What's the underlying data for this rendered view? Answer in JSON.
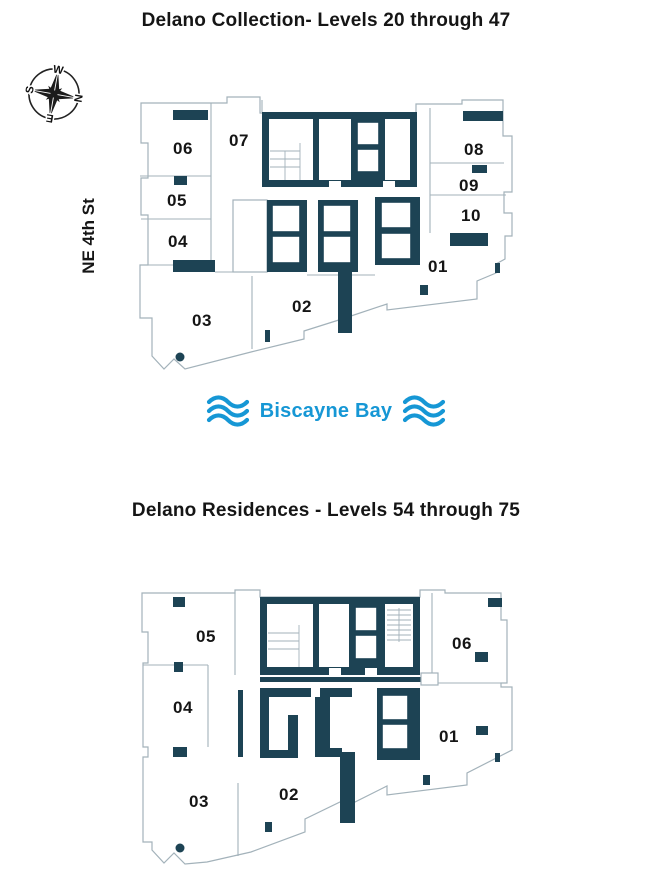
{
  "colors": {
    "wall": "#1d4354",
    "outline": "#a3b2ba",
    "bay": "#1697d5",
    "ink": "#151515"
  },
  "compass": {
    "n": "N",
    "e": "E",
    "s": "S",
    "w": "W"
  },
  "street": {
    "label": "NE 4th St"
  },
  "bay": {
    "label": "Biscayne Bay"
  },
  "plans": [
    {
      "title": "Delano Collection- Levels 20 through 47",
      "units": [
        {
          "id": "06"
        },
        {
          "id": "07"
        },
        {
          "id": "08"
        },
        {
          "id": "09"
        },
        {
          "id": "10"
        },
        {
          "id": "05"
        },
        {
          "id": "04"
        },
        {
          "id": "01"
        },
        {
          "id": "02"
        },
        {
          "id": "03"
        }
      ]
    },
    {
      "title": "Delano Residences - Levels 54 through 75",
      "units": [
        {
          "id": "05"
        },
        {
          "id": "06"
        },
        {
          "id": "04"
        },
        {
          "id": "01"
        },
        {
          "id": "02"
        },
        {
          "id": "03"
        }
      ]
    }
  ]
}
